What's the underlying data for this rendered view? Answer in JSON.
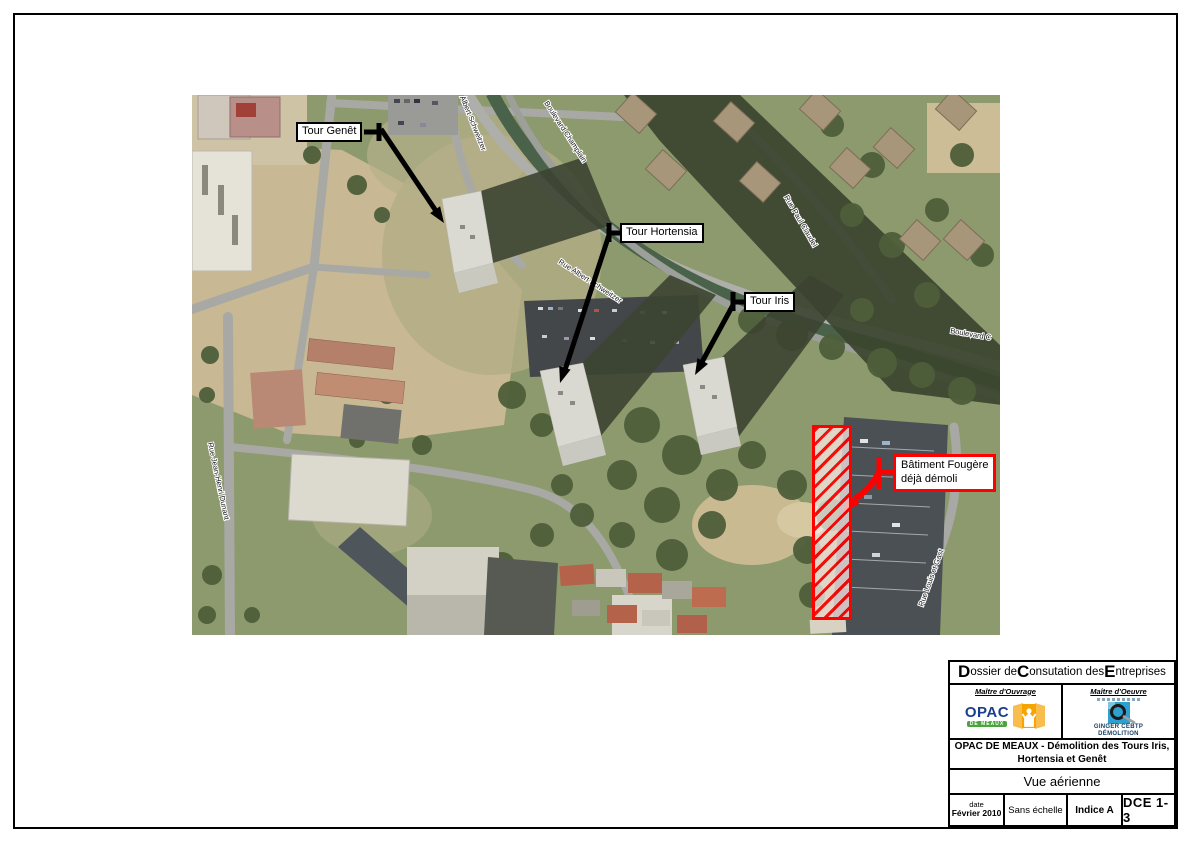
{
  "map": {
    "tower_labels": [
      {
        "label": "Tour Genêt"
      },
      {
        "label": "Tour Hortensia"
      },
      {
        "label": "Tour Iris"
      }
    ],
    "demolished_label": {
      "line1": "Bâtiment Fougère",
      "line2": "déjà démoli"
    },
    "street_labels": [
      {
        "text": "Albert Schweitzer"
      },
      {
        "text": "Boulevard Champlain"
      },
      {
        "text": "Rue Albert Schweitzer"
      },
      {
        "text": "Rue Paul Claudel"
      },
      {
        "text": "Boulevard C"
      },
      {
        "text": "Rue Louis et Gast"
      },
      {
        "text": "Rue Jean-Henri Dunant"
      }
    ],
    "colors": {
      "annotation_black": "#000000",
      "annotation_red": "#ff0000"
    }
  },
  "title_block": {
    "header": {
      "seg1_big": "D",
      "seg1_rest": "ossier de ",
      "seg2_big": "C",
      "seg2_rest": "onsutation des ",
      "seg3_big": "E",
      "seg3_rest": "ntreprises"
    },
    "owner": {
      "caption": "Maître d'Ouvrage",
      "logo_text": "OPAC",
      "logo_subtext": "DE MEAUX"
    },
    "engineer": {
      "caption": "Maître d'Oeuvre",
      "logo_line1": "GINGER CEBTP",
      "logo_line2": "DÉMOLITION"
    },
    "project_title_line1": "OPAC DE MEAUX - Démolition des Tours Iris,",
    "project_title_line2": "Hortensia et Genêt",
    "sheet_title": "Vue aérienne",
    "footer": {
      "date_label": "date",
      "date_value": "Février 2010",
      "scale": "Sans échelle",
      "revision": "Indice A",
      "doc_ref": "DCE 1-3"
    },
    "logo_colors": {
      "opac_blue": "#1b3f8f",
      "opac_green": "#4aa53c",
      "opac_orange": "#f6a500",
      "ginger_blue": "#2f9fd0"
    }
  }
}
